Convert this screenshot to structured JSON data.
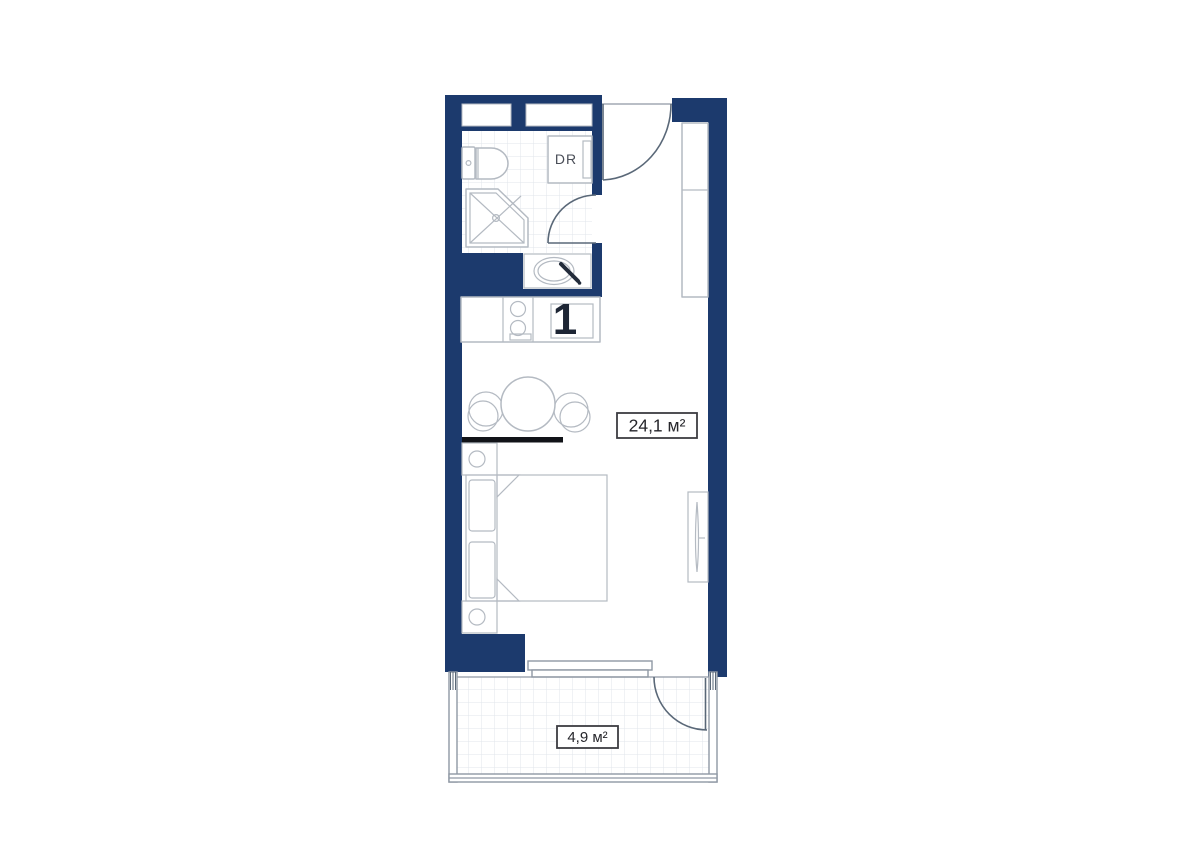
{
  "plan": {
    "type": "floor-plan",
    "unit_number": "1",
    "rooms": [
      {
        "name": "studio",
        "area_label": "24,1 м²"
      },
      {
        "name": "balcony",
        "area_label": "4,9 м²"
      }
    ],
    "labels": {
      "closet": "DR"
    },
    "colors": {
      "wall": "#1c3a6d",
      "outline": "#b4bac2",
      "tile": "#e1e5eb",
      "door": "#5a6878",
      "thin-wall": "#8f98a4",
      "divider": "#111318",
      "text-dark": "#26262b",
      "text-muted": "#4a4e58",
      "accent-number": "#1d2534",
      "faucet": "#232c3b",
      "label-border": "#3c3c42"
    }
  }
}
